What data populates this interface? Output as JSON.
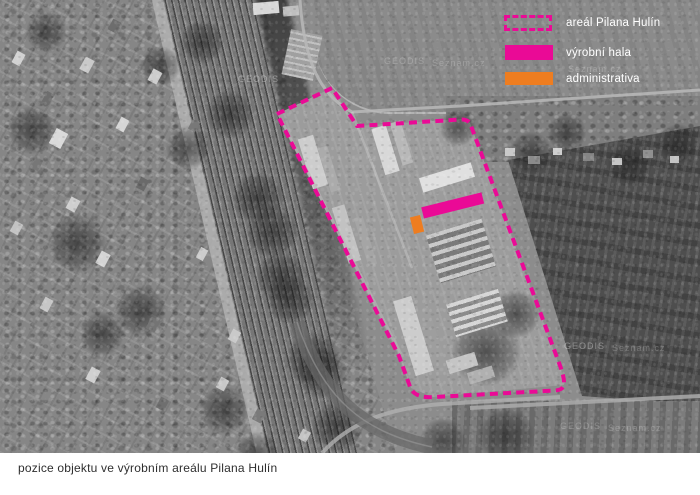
{
  "legend": {
    "items": [
      {
        "label": "areál Pilana Hulín",
        "swatch": "magenta-dashed-outline"
      },
      {
        "label": "výrobní hala",
        "swatch": "magenta-fill"
      },
      {
        "label": "administrativa",
        "swatch": "orange-fill"
      }
    ]
  },
  "caption": {
    "text": "pozice objektu ve výrobním areálu Pilana Hulín"
  },
  "map": {
    "watermarks": [
      "GEODIS",
      "Seznam.cz"
    ]
  },
  "colors": {
    "magenta": "#ea0a96",
    "orange": "#ee7d20"
  }
}
